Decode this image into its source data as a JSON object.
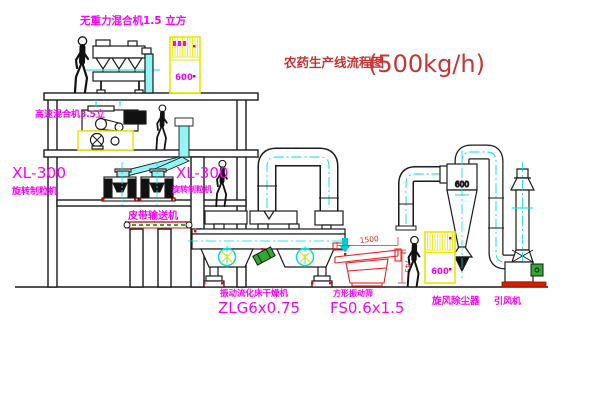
{
  "title": {
    "main": "农药生产线流程图",
    "capacity": "(500kg/h)"
  },
  "labels": {
    "gravity_mixer": "无重力混合机1.5 立方",
    "high_speed_mixer": "高速混合机3.5立",
    "granulator_left_model": "XL-300",
    "granulator_left_name": "旋转制粒机",
    "granulator_center_model": "XL-300",
    "granulator_center_name": "旋转制粒机",
    "belt_conveyor": "皮带输送机",
    "dryer_name": "振动流化床干燥机",
    "dryer_model": "ZLG6x0.75",
    "screen_name": "方形振动筛",
    "screen_model": "FS0.6x1.5",
    "cyclone": "旋风除尘器",
    "fan": "引风机"
  },
  "annotations": {
    "cabinet1_panel": "600",
    "cabinet2_panel": "600",
    "cyclone_diameter": "600",
    "screen_length_dim": "1500",
    "screen_height_dim": "745"
  },
  "colors": {
    "title": "#cc3333",
    "label": "#ff00ff",
    "line": "#1a1a1a",
    "centerline": "#00dede",
    "cabinet": "#e8e800",
    "dimension": "#ee2222",
    "chute": "#8ff5f5",
    "motor_green": "#2faa2f",
    "dot_red": "#ff0000"
  }
}
